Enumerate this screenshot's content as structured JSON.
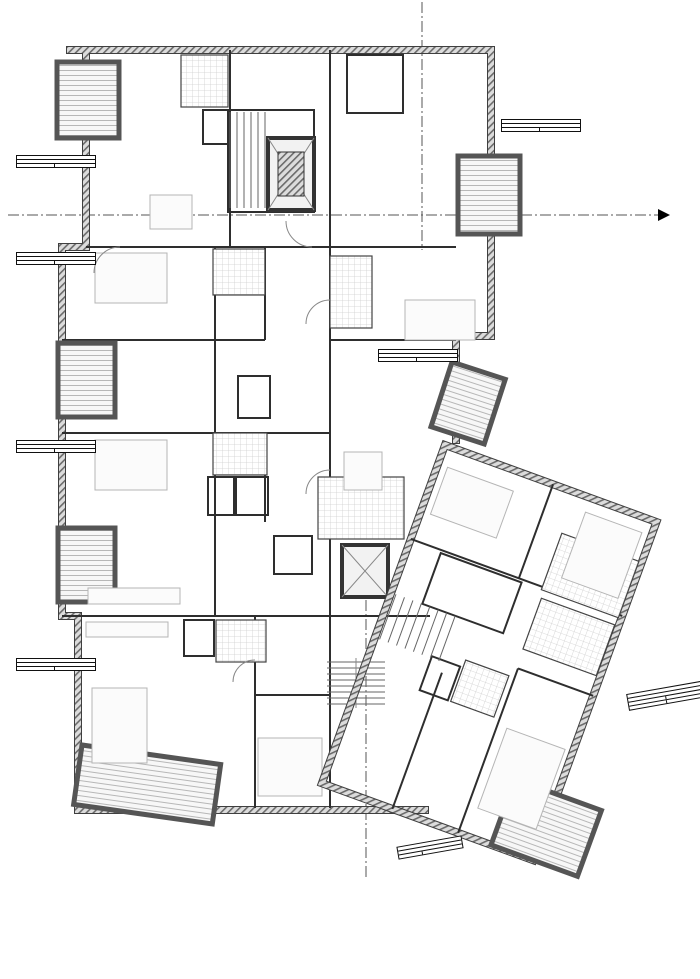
{
  "title": "1.Obergeschoss",
  "section_marks": {
    "aa": "A-A",
    "b1": "B1-B1",
    "b2": "B2-B2"
  },
  "apartments": [
    {
      "id": "H1.01.W8",
      "type": "1-Zi.-Wohnung",
      "rows": [
        {
          "label": "Summe",
          "value": "40,08 m²"
        }
      ]
    },
    {
      "id": "H1.01.W9",
      "type": "2-Zi.-Wohnung",
      "rows": [
        {
          "label": "Summe",
          "value": "48,97 m²"
        }
      ]
    },
    {
      "id": "H1.01.W10",
      "type": "2-Zi.-Wohnung",
      "rows": [
        {
          "label": "Summe",
          "value": "56,48 m²"
        }
      ]
    },
    {
      "id": "H1.01.W11",
      "type": "2-Zi.-Wohnung",
      "rows": [
        {
          "label": "Summe",
          "value": "62,56 m²"
        }
      ]
    },
    {
      "id": "H1.01.W13",
      "type": "2-Zi.-Wohnung",
      "rows": [
        {
          "label": "Summe",
          "value": "82,91 m²"
        }
      ]
    },
    {
      "id": "H1.01.W14",
      "type": "2-Zi.-Wohnung",
      "rows": [
        {
          "label": "Summe",
          "value": "62,39 m²"
        }
      ]
    },
    {
      "id": "H1.01.W5",
      "type": "4-Zi.-Wohnung",
      "rows": [
        {
          "label": "OG",
          "value": "59,49 m²"
        },
        {
          "label": "Gesamt",
          "value": "149,82 m²"
        }
      ]
    },
    {
      "id": "H1.01.W12",
      "type": "1-Zi.-Wohnung",
      "rows": [
        {
          "label": "Summe",
          "value": "24,55 m²"
        }
      ]
    }
  ],
  "rooms": [
    {
      "name": "Loggia",
      "area": "3,25 m²",
      "no": "8"
    },
    {
      "name": "Wohnen/Küche/Schlafen",
      "area": "31,35 m²",
      "no": "8"
    },
    {
      "name": "Du.Bad",
      "area": "4,02 m²",
      "no": "8"
    },
    {
      "name": "Abst.",
      "area": "1,96 m²",
      "no": "8"
    },
    {
      "name": "Treppenhaus",
      "area": "23,54 m²",
      "no": "G"
    },
    {
      "name": "Abst.",
      "area": "2,64 m²",
      "no": "14"
    },
    {
      "name": "Wohnen/Küche",
      "area": "32,61 m²",
      "no": "14"
    },
    {
      "name": "Loggia",
      "area": "3,25 m²",
      "no": "14"
    },
    {
      "name": "Schlafen 1",
      "area": "17,47 m²",
      "no": "9"
    },
    {
      "name": "Du.Bad",
      "area": "4,33 m²",
      "no": "9"
    },
    {
      "name": "Flur",
      "area": "3,26 m²",
      "no": "14"
    },
    {
      "name": "Du.Bad",
      "area": "4,74 m²",
      "no": "14"
    },
    {
      "name": "Schlafen",
      "area": "15,89 m²",
      "no": "14"
    },
    {
      "name": "Flur",
      "area": "11,37 m²",
      "no": "G"
    },
    {
      "name": "Loggia",
      "area": "3,25 m²",
      "no": "9"
    },
    {
      "name": "Wohnen/Küche",
      "area": "22,07 m²",
      "no": "9"
    },
    {
      "name": "Abst.",
      "area": "1,85 m²",
      "no": "9"
    },
    {
      "name": "Loggia",
      "area": "2,75 m²",
      "no": "13"
    },
    {
      "name": "Schlafen",
      "area": "17,93 m²",
      "no": "10"
    },
    {
      "name": "Du.Bad",
      "area": "4,77 m²",
      "no": "10"
    },
    {
      "name": "Flur",
      "area": "7,09 m²",
      "no": "13"
    },
    {
      "name": "Wohnen/Küche",
      "area": "38,26 m²",
      "no": "13"
    },
    {
      "name": "Abst.",
      "area": "2,31 m²",
      "no": "10"
    },
    {
      "name": "Flur",
      "area": "1,92 m²",
      "no": "10"
    },
    {
      "name": "Abst.",
      "area": "",
      "no": "13"
    },
    {
      "name": "Du.Bad",
      "area": "7,83 m²",
      "no": "13"
    },
    {
      "name": "Schlafen",
      "area": "17,21 m²",
      "no": "13"
    },
    {
      "name": "Schlafen 3",
      "area": "17,30 m²",
      "no": "5"
    },
    {
      "name": "Loggia",
      "area": "3,25 m²",
      "no": "10"
    },
    {
      "name": "Wohnen/Küche",
      "area": "21,30 m²",
      "no": "10"
    },
    {
      "name": "Ankleide",
      "area": "6,41 m²",
      "no": "13"
    },
    {
      "name": "Bad",
      "area": "5,47 m²",
      "no": "5"
    },
    {
      "name": "Du.Bad",
      "area": "5,53 m²",
      "no": "5"
    },
    {
      "name": "Abst.",
      "area": "1,99 m²",
      "no": "11"
    },
    {
      "name": "Du.Bad",
      "area": "4,86 m²",
      "no": "11"
    },
    {
      "name": "Wohnen/Küche",
      "area": "27,89 m²",
      "no": "11"
    },
    {
      "name": "Flur",
      "area": "7,32 m²",
      "no": "11"
    },
    {
      "name": "Flur",
      "area": "6,48 m²",
      "no": "5"
    },
    {
      "name": "Abst.",
      "area": "2,47 m²",
      "no": "12"
    },
    {
      "name": "Du.Bad",
      "area": "3,70 m²",
      "no": "12"
    },
    {
      "name": "Schlafen",
      "area": "14,64 m²",
      "no": "11"
    },
    {
      "name": "Schlafen 2",
      "area": "18,21 m²",
      "no": "5"
    },
    {
      "name": "Treppenhaus/Flur",
      "area": "33,73 m²",
      "no": "G"
    },
    {
      "name": "Wohnen/Küche /Schlafen",
      "area": "18,38 m²",
      "no": "12"
    },
    {
      "name": "Loggia",
      "area": "5,88 m²",
      "no": "11"
    },
    {
      "name": "Loggia",
      "area": "3,25 m²",
      "no": ""
    }
  ]
}
